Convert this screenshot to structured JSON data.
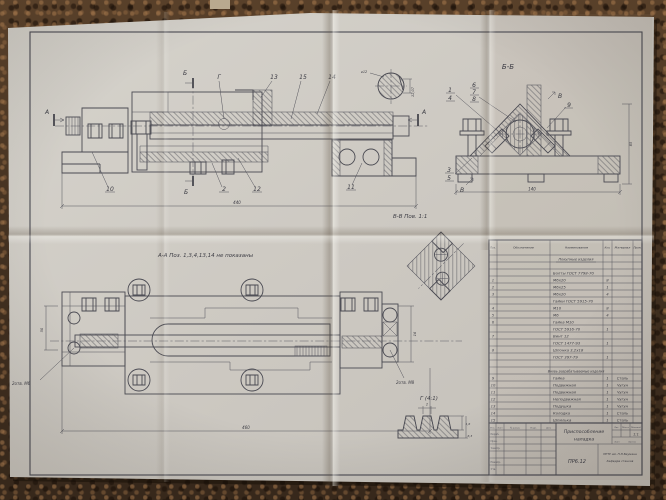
{
  "colors": {
    "carpet": "#4e3926",
    "paper": "#cecac3",
    "ink": "#46464c"
  },
  "d": {
    "front": {
      "a": "А",
      "b": "Б",
      "g": "Г",
      "n13": "13",
      "n15": "15",
      "n14": "14",
      "n10": "10",
      "n2": "2",
      "n12": "12",
      "n11": "11",
      "dim": "440"
    },
    "shaft": {
      "d1": "⌀12",
      "d2": "12,07"
    },
    "bb": {
      "t": "Б-Б",
      "n1": "1",
      "n4": "4",
      "n6": "6",
      "n7": "7",
      "n8": "8",
      "n9": "9",
      "n3": "3",
      "n5": "5",
      "v": "В",
      "dw": "140",
      "dh": "85"
    },
    "vv": {
      "t": "В-В Пов. 1:1"
    },
    "aa": {
      "t": "А-А Поз. 1,3,4,13,14 не показаны",
      "nl": "2отв. М6",
      "nr": "2отв. М8",
      "dim": "460",
      "dl": "50",
      "dr": "16"
    },
    "g": {
      "t": "Г (4:1)",
      "d1": "2",
      "d2": "1,6",
      "d3": "6,3"
    }
  },
  "spec": {
    "h": [
      "Поз.",
      "Обозначение",
      "Наименование",
      "Кол.",
      "Материал",
      "Прим."
    ],
    "s1": "Покупные изделия",
    "s2": "Вновь разрабатываемые изделия",
    "r": [
      {
        "p": "",
        "n": "Болты ГОСТ 7798-70",
        "q": ""
      },
      {
        "p": "1",
        "n": "М6х20",
        "q": "8"
      },
      {
        "p": "2",
        "n": "М6х25",
        "q": "1"
      },
      {
        "p": "3",
        "n": "М6х20",
        "q": "4"
      },
      {
        "p": "",
        "n": "Гайки ГОСТ 5915-70",
        "q": ""
      },
      {
        "p": "4",
        "n": "М10",
        "q": "8"
      },
      {
        "p": "5",
        "n": "М6",
        "q": "4"
      },
      {
        "p": "6",
        "n": "Гайка М10",
        "q": ""
      },
      {
        "p": "",
        "n": "ГОСТ 5916-70",
        "q": "1"
      },
      {
        "p": "7",
        "n": "Винт 12",
        "q": ""
      },
      {
        "p": "",
        "n": "ГОСТ 1477-93",
        "q": "1"
      },
      {
        "p": "8",
        "n": "Шпонка 3,2х18",
        "q": ""
      },
      {
        "p": "",
        "n": "ГОСТ 397-79",
        "q": "1"
      }
    ],
    "r2": [
      {
        "p": "9",
        "n": "Гайка",
        "q": "1",
        "m": "Сталь"
      },
      {
        "p": "10",
        "n": "Подвижная",
        "q": "1",
        "m": "Чугун"
      },
      {
        "p": "11",
        "n": "Подвижная",
        "q": "1",
        "m": "Чугун"
      },
      {
        "p": "12",
        "n": "Неподвижная",
        "q": "1",
        "m": "Чугун"
      },
      {
        "p": "13",
        "n": "Подушка",
        "q": "1",
        "m": "Чугун"
      },
      {
        "p": "14",
        "n": "Колодка",
        "q": "1",
        "m": "Сталь"
      },
      {
        "p": "15",
        "n": "Шпилька",
        "q": "1",
        "m": "Сталь"
      }
    ]
  },
  "tb": {
    "name1": "Приспособление",
    "name2": "наладка",
    "no": "ПР6.12",
    "scale": "1:1",
    "org1": "МГТУ им. Н.Э.Баумана",
    "org2": "Кафедра станков",
    "izm": "Изм.",
    "list": "Лист",
    "doc": "№ докум.",
    "podp": "Подп.",
    "data": "Дата",
    "razrab": "Разраб.",
    "prov": "Пров.",
    "tk": "Т.контр.",
    "nk": "Н.контр.",
    "utv": "Утв.",
    "lit": "Лит.",
    "massa": "Масса",
    "mashtab": "Масштаб",
    "list2": "Лист",
    "listov": "Листов"
  }
}
